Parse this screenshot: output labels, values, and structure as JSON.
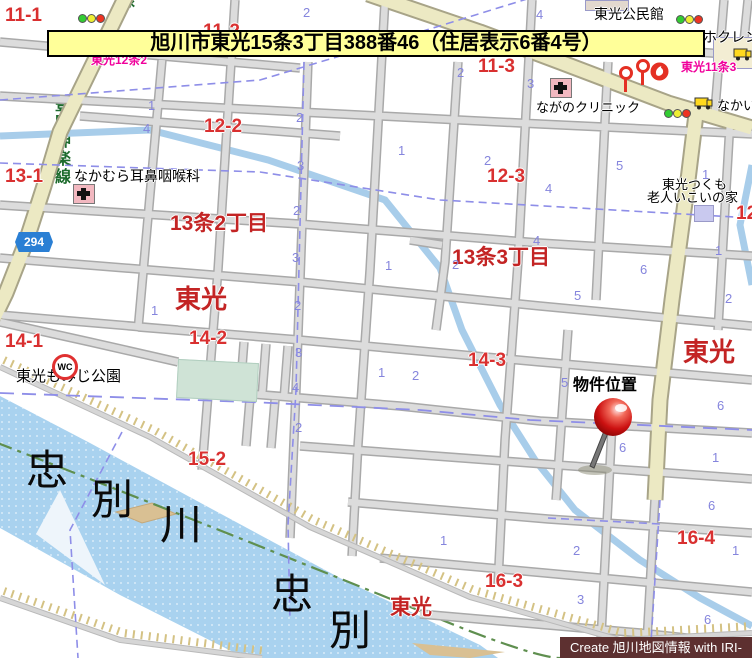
{
  "banner": {
    "text": "旭川市東光15条3丁目388番46（住居表示6番4号）"
  },
  "credit": {
    "text": "Create 旭川地図情報 with IRI-GO"
  },
  "colors": {
    "banner_bg": "#ffff99",
    "district_red": "#d93030",
    "area_red": "#c32424",
    "sign_magenta": "#f0009b",
    "lot_blue": "#8585dd",
    "water": "#a9d2ef",
    "major_road": "#ece9c3",
    "credit_bg": "#5d3030",
    "pin_red": "#cc1111",
    "boundary_dash": "#8e8ee8",
    "road_name_green": "#1d6b2d"
  },
  "map": {
    "district_numbers": [
      {
        "t": "11-1",
        "x": 5,
        "y": 6
      },
      {
        "t": "11-2",
        "x": 203,
        "y": 22
      },
      {
        "t": "11-3",
        "x": 478,
        "y": 57
      },
      {
        "t": "12-2",
        "x": 204,
        "y": 117
      },
      {
        "t": "12-3",
        "x": 487,
        "y": 167
      },
      {
        "t": "12-4",
        "x": 736,
        "y": 204
      },
      {
        "t": "13-1",
        "x": 5,
        "y": 167
      },
      {
        "t": "14-1",
        "x": 5,
        "y": 332
      },
      {
        "t": "14-2",
        "x": 189,
        "y": 329
      },
      {
        "t": "14-3",
        "x": 468,
        "y": 351
      },
      {
        "t": "15-2",
        "x": 188,
        "y": 450
      },
      {
        "t": "16-3",
        "x": 485,
        "y": 572
      },
      {
        "t": "16-4",
        "x": 677,
        "y": 529
      }
    ],
    "area_names": [
      {
        "t": "13条2丁目",
        "x": 170,
        "y": 213,
        "s": 21
      },
      {
        "t": "13条3丁目",
        "x": 452,
        "y": 247,
        "s": 21
      },
      {
        "t": "東光",
        "x": 175,
        "y": 286,
        "s": 26
      },
      {
        "t": "東光",
        "x": 683,
        "y": 339,
        "s": 26
      },
      {
        "t": "東光",
        "x": 390,
        "y": 597,
        "s": 21
      }
    ],
    "sign_labels": [
      {
        "t": "東光12条2",
        "x": 91,
        "y": 54
      },
      {
        "t": "東光11条3",
        "x": 681,
        "y": 61
      }
    ],
    "facilities": [
      {
        "t": "東光公民館",
        "x": 594,
        "y": 7,
        "s": 14
      },
      {
        "t": "ホクレン",
        "x": 703,
        "y": 30,
        "s": 14
      },
      {
        "t": "なかい",
        "x": 717,
        "y": 99,
        "s": 13
      },
      {
        "t": "ながのクリニック",
        "x": 536,
        "y": 101,
        "s": 13
      },
      {
        "t": "なかむら耳鼻咽喉科",
        "x": 74,
        "y": 169,
        "s": 14
      },
      {
        "t": "東光つくも",
        "x": 662,
        "y": 178,
        "s": 13
      },
      {
        "t": "老人いこいの家",
        "x": 647,
        "y": 191,
        "s": 13
      },
      {
        "t": "東光もみじ公園",
        "x": 16,
        "y": 369,
        "s": 15
      },
      {
        "t": "物件位置",
        "x": 573,
        "y": 378,
        "s": 16,
        "w": "bold"
      }
    ],
    "river_chars": [
      {
        "t": "忠",
        "x": 26,
        "y": 450
      },
      {
        "t": "別",
        "x": 91,
        "y": 479
      },
      {
        "t": "川",
        "x": 160,
        "y": 504
      },
      {
        "t": "忠",
        "x": 271,
        "y": 574
      },
      {
        "t": "別",
        "x": 329,
        "y": 610
      }
    ],
    "lot_numbers": [
      {
        "t": "2",
        "x": 303,
        "y": 6
      },
      {
        "t": "4",
        "x": 536,
        "y": 8
      },
      {
        "t": "2",
        "x": 457,
        "y": 66
      },
      {
        "t": "1",
        "x": 148,
        "y": 99
      },
      {
        "t": "4",
        "x": 143,
        "y": 122
      },
      {
        "t": "2",
        "x": 296,
        "y": 111
      },
      {
        "t": "3",
        "x": 297,
        "y": 159
      },
      {
        "t": "1",
        "x": 398,
        "y": 144
      },
      {
        "t": "2",
        "x": 484,
        "y": 154
      },
      {
        "t": "2",
        "x": 293,
        "y": 204
      },
      {
        "t": "3",
        "x": 292,
        "y": 251
      },
      {
        "t": "1",
        "x": 385,
        "y": 259
      },
      {
        "t": "2",
        "x": 452,
        "y": 258
      },
      {
        "t": "4",
        "x": 545,
        "y": 182
      },
      {
        "t": "5",
        "x": 616,
        "y": 159
      },
      {
        "t": "4",
        "x": 533,
        "y": 234
      },
      {
        "t": "6",
        "x": 640,
        "y": 263
      },
      {
        "t": "5",
        "x": 574,
        "y": 289
      },
      {
        "t": "1",
        "x": 702,
        "y": 168
      },
      {
        "t": "1",
        "x": 715,
        "y": 244
      },
      {
        "t": "2",
        "x": 725,
        "y": 292
      },
      {
        "t": "1",
        "x": 378,
        "y": 366
      },
      {
        "t": "2",
        "x": 412,
        "y": 369
      },
      {
        "t": "1",
        "x": 151,
        "y": 304
      },
      {
        "t": "2",
        "x": 294,
        "y": 299
      },
      {
        "t": "3",
        "x": 295,
        "y": 346
      },
      {
        "t": "4",
        "x": 292,
        "y": 381
      },
      {
        "t": "2",
        "x": 295,
        "y": 421
      },
      {
        "t": "5",
        "x": 561,
        "y": 376
      },
      {
        "t": "6",
        "x": 619,
        "y": 441
      },
      {
        "t": "6",
        "x": 717,
        "y": 399
      },
      {
        "t": "1",
        "x": 712,
        "y": 451
      },
      {
        "t": "6",
        "x": 708,
        "y": 499
      },
      {
        "t": "2",
        "x": 573,
        "y": 544
      },
      {
        "t": "1",
        "x": 732,
        "y": 544
      },
      {
        "t": "3",
        "x": 577,
        "y": 593
      },
      {
        "t": "1",
        "x": 440,
        "y": 534
      },
      {
        "t": "6",
        "x": 704,
        "y": 613
      },
      {
        "t": "4",
        "x": 595,
        "y": 636
      },
      {
        "t": "3",
        "x": 527,
        "y": 77
      }
    ],
    "road_name_vertical": {
      "text": "豊岡神楽線",
      "partial_top": "線"
    },
    "route_shield": {
      "number": "294"
    },
    "wc_icon_text": "WC",
    "icon_names": [
      "traffic-light",
      "hospital-cross",
      "wc",
      "route-shield",
      "lollipop-sign",
      "fire-station",
      "shop-truck",
      "building",
      "red-dot",
      "property-pin"
    ]
  }
}
